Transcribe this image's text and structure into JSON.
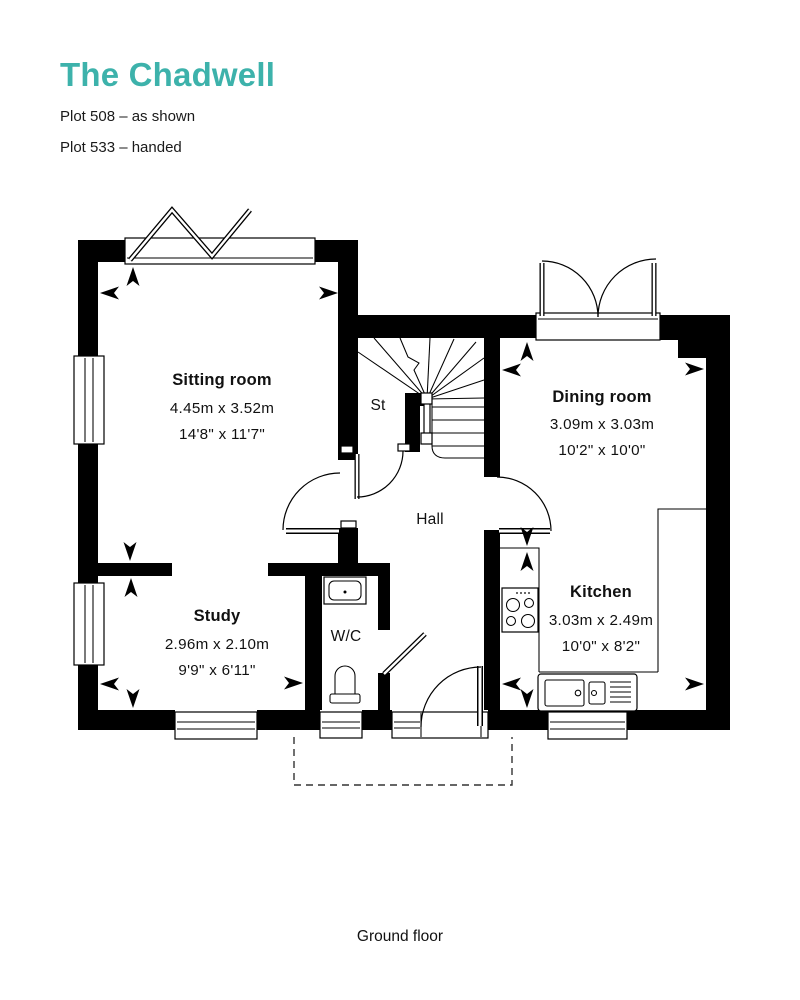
{
  "header": {
    "title": "The Chadwell",
    "plot_line_1": "Plot 508 – as shown",
    "plot_line_2": "Plot 533 – handed"
  },
  "colors": {
    "accent": "#3DB2AB",
    "text": "#111111",
    "wall": "#000000"
  },
  "floorplan": {
    "caption": "Ground floor",
    "rooms": [
      {
        "name": "Sitting room",
        "metric": "4.45m x 3.52m",
        "imperial": "14'8\" x 11'7\""
      },
      {
        "name": "Dining room",
        "metric": "3.09m x 3.03m",
        "imperial": "10'2\" x 10'0\""
      },
      {
        "name": "Study",
        "metric": "2.96m x 2.10m",
        "imperial": "9'9\" x 6'11\""
      },
      {
        "name": "Kitchen",
        "metric": "3.03m x 2.49m",
        "imperial": "10'0\" x 8'2\""
      }
    ],
    "labels": {
      "stairs_cupboard": "St",
      "hall": "Hall",
      "wc": "W/C"
    }
  }
}
